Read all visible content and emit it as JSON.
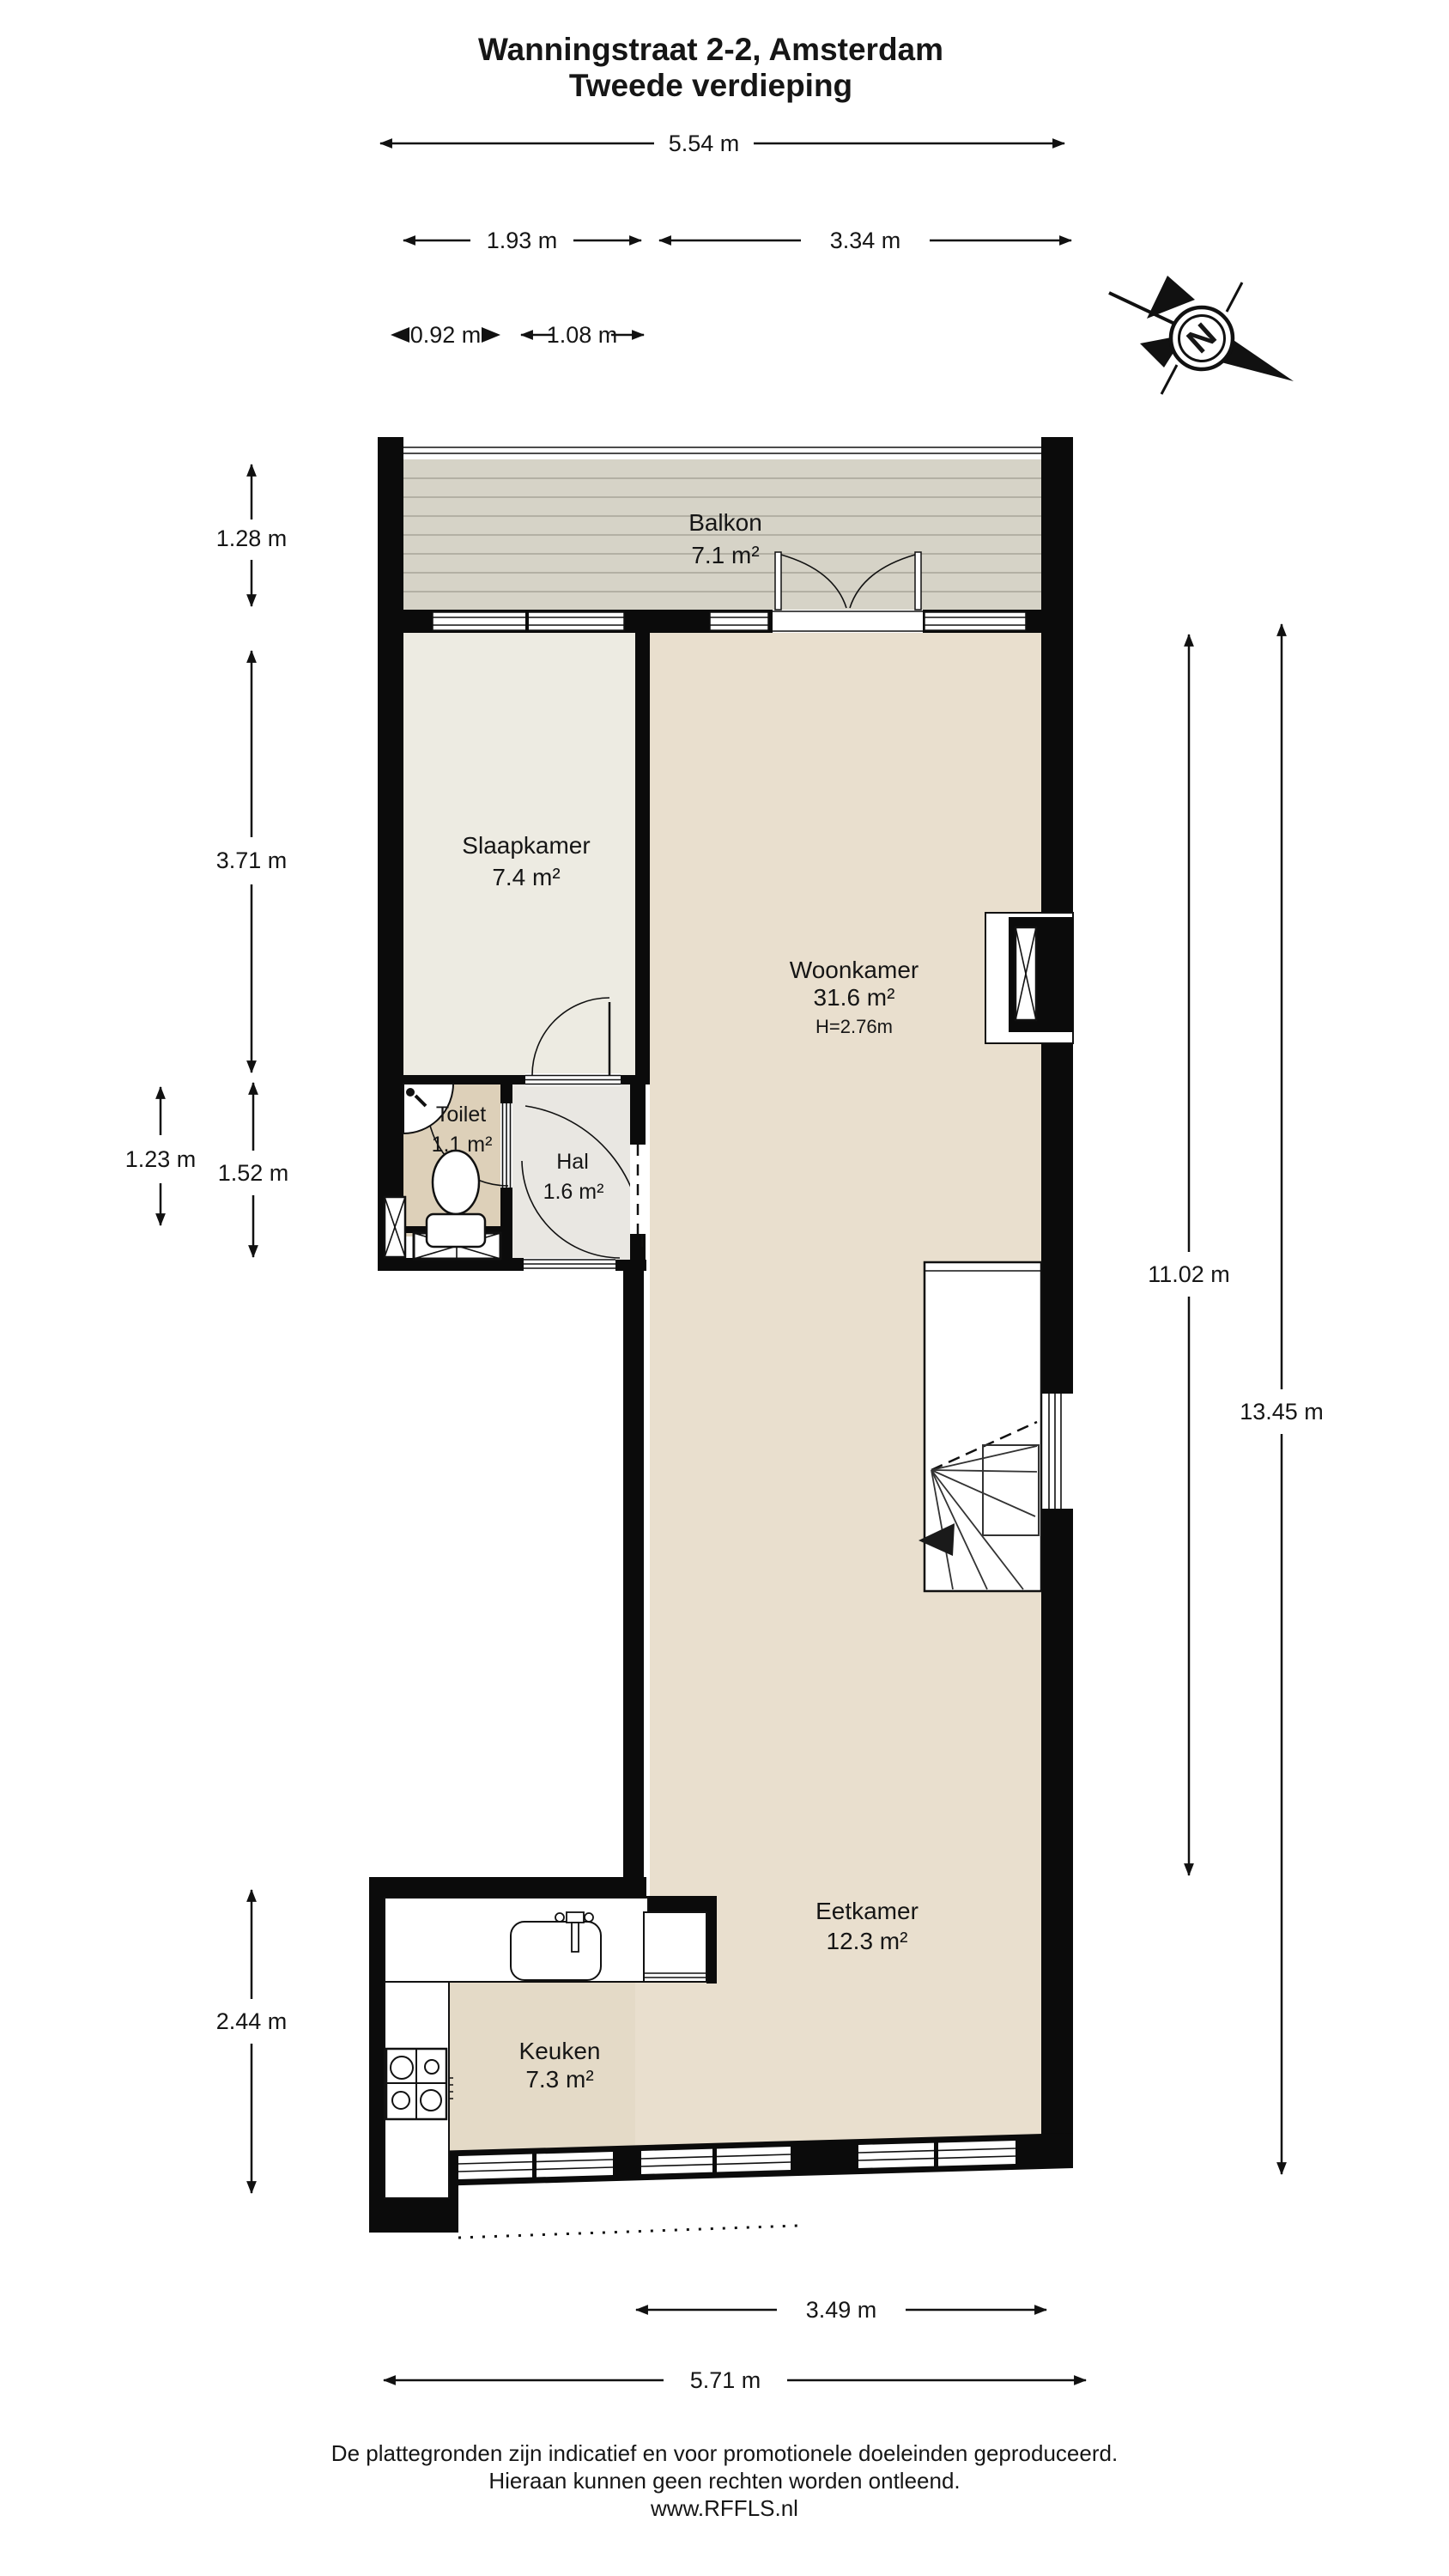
{
  "title": {
    "line1": "Wanningstraat 2-2, Amsterdam",
    "line2": "Tweede verdieping"
  },
  "compass": {
    "north_label": "N"
  },
  "rooms": {
    "balkon": {
      "name": "Balkon",
      "area": "7.1 m²"
    },
    "slaapkamer": {
      "name": "Slaapkamer",
      "area": "7.4 m²"
    },
    "woonkamer": {
      "name": "Woonkamer",
      "area": "31.6 m²",
      "ceiling_height": "H=2.76m"
    },
    "toilet": {
      "name": "Toilet",
      "area": "1.1 m²"
    },
    "hal": {
      "name": "Hal",
      "area": "1.6 m²"
    },
    "eetkamer": {
      "name": "Eetkamer",
      "area": "12.3 m²"
    },
    "keuken": {
      "name": "Keuken",
      "area": "7.3 m²"
    }
  },
  "dimensions": {
    "top_total": "5.54 m",
    "top_left": "1.93 m",
    "top_right": "3.34 m",
    "small_left": "0.92 m",
    "small_right": "1.08 m",
    "left_balkon": "1.28 m",
    "left_slaapkamer": "3.71 m",
    "left_toilet_outer": "1.23 m",
    "left_toilet_inner": "1.52 m",
    "left_keuken": "2.44 m",
    "right_inner": "11.02 m",
    "right_outer": "13.45 m",
    "bottom_inner": "3.49 m",
    "bottom_outer": "5.71 m"
  },
  "footer": {
    "line1": "De plattegronden zijn indicatief en voor promotionele doeleinden geproduceerd.",
    "line2": "Hieraan kunnen geen rechten worden ontleend.",
    "line3": "www.RFFLS.nl"
  },
  "colors": {
    "wall": "#0b0b0b",
    "balkon_floor": "#d6d3c7",
    "balkon_stripe": "#aeab9f",
    "slaapkamer_floor": "#edebe2",
    "woonkamer_floor": "#e9dfce",
    "keuken_floor": "#e4dac7",
    "hal_floor": "#e9e7e2",
    "toilet_floor": "#ddd0b9"
  }
}
